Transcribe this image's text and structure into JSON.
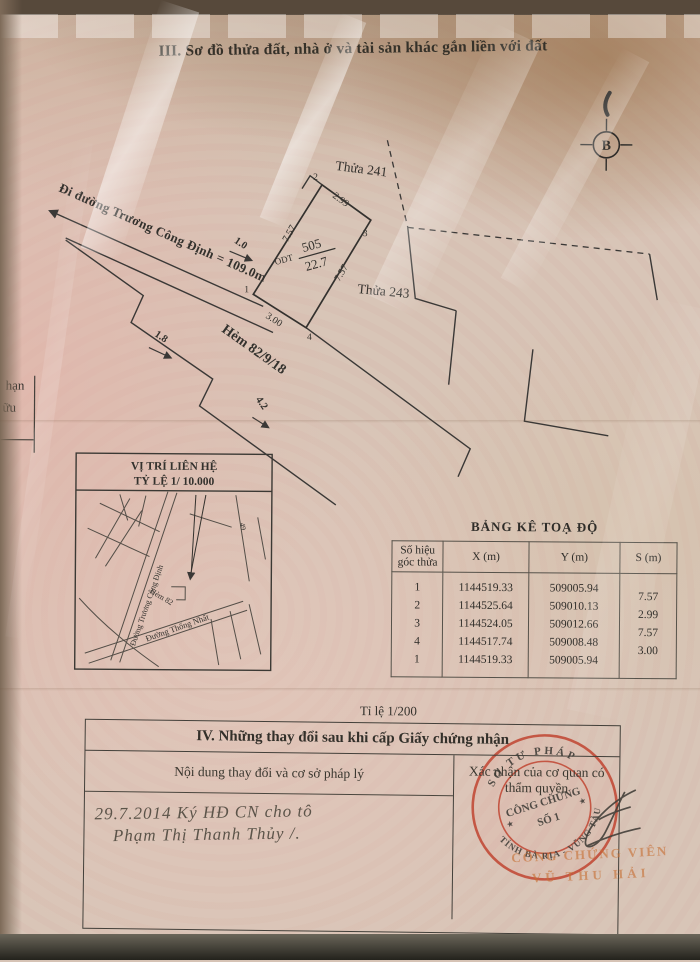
{
  "page": {
    "section3_title": "III. Sơ đồ thửa đất, nhà ở và tài sản khác gắn liền với đất",
    "north_label": "B",
    "scale_note": "Tỉ lệ 1/200",
    "margin_fragments": [
      "hạn",
      "ữu"
    ]
  },
  "diagram": {
    "street_label": "Đi đường Trương Công Định = 109.0m",
    "alley_label": "Hẻm 82/9/18",
    "plot_type": "ODT",
    "plot_number": "505",
    "plot_area": "22.7",
    "neighbor_top": "Thửa 241",
    "neighbor_right": "Thửa 243",
    "corners": [
      "1",
      "2",
      "3",
      "4"
    ],
    "dims": {
      "left": "7.57",
      "top": "2.99",
      "right": "7.57",
      "bottom": "3.00",
      "d1": "1.0",
      "d2": "1.8",
      "d3": "4.2"
    }
  },
  "minimap": {
    "title1": "VỊ TRÍ LIÊN HỆ",
    "title2": "TỶ LỆ 1/ 10.000",
    "street_main": "Đường Trương Công Định",
    "street_alley": "Hẻm 82",
    "street_bottom": "Đường Thống Nhất",
    "street_num": "49"
  },
  "coord_table": {
    "title": "BẢNG KÊ TOẠ ĐỘ",
    "headers": [
      "Số hiệu\ngóc thửa",
      "X (m)",
      "Y (m)",
      "S (m)"
    ],
    "rows": [
      [
        "1",
        "1144519.33",
        "509005.94",
        ""
      ],
      [
        "2",
        "1144525.64",
        "509010.13",
        "7.57"
      ],
      [
        "3",
        "1144524.05",
        "509012.66",
        "2.99"
      ],
      [
        "4",
        "1144517.74",
        "509008.48",
        "7.57"
      ],
      [
        "1",
        "1144519.33",
        "509005.94",
        "3.00"
      ]
    ]
  },
  "section4": {
    "title": "IV. Những thay đổi sau khi cấp Giấy chứng nhận",
    "col_left": "Nội dung thay đổi và cơ sở pháp lý",
    "col_right": "Xác nhận của cơ quan có thẩm quyền",
    "handwriting_line1": "29.7.2014  Ký HĐ CN cho tô",
    "handwriting_line2": "Phạm Thị Thanh Thủy /.",
    "stamp": {
      "ring_top": "SỞ TƯ PHÁP",
      "ring_bottom": "TỈNH BÀ RỊA - VŨNG TÀU",
      "center1": "CÔNG CHỨNG",
      "center2": "SỐ 1",
      "star": "★",
      "color": "#c0402c"
    },
    "notary_line1": "CÔNG CHỨNG VIÊN",
    "notary_line2": "VŨ THU HẢI"
  }
}
